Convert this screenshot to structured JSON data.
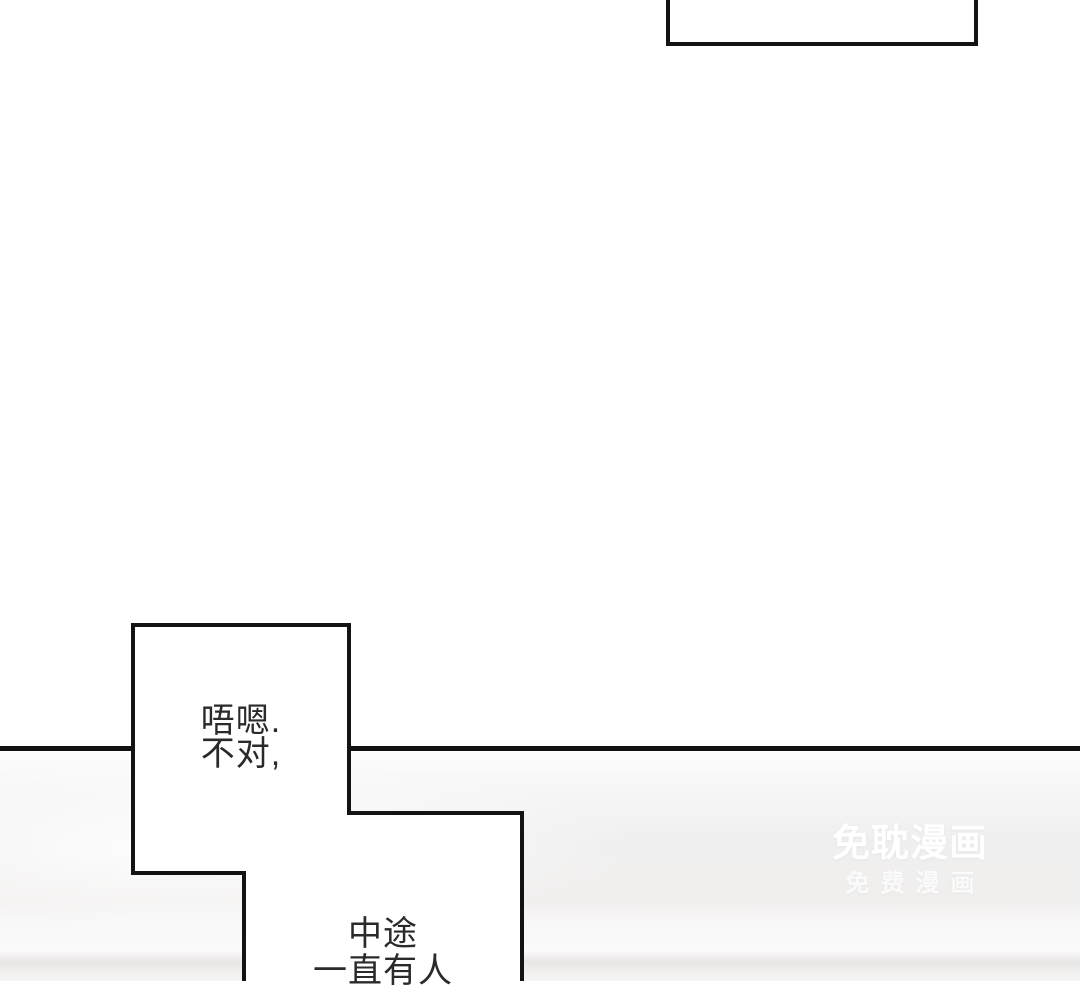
{
  "page": {
    "background_color": "#ffffff",
    "divider_color": "#111111",
    "bubble_border_color": "#131313",
    "bubble_fill_color": "#ffffff",
    "text_color": "#2a2a2a",
    "floor_shadow_color": "#e8e6e5",
    "lower_panel_color": "#f0efef"
  },
  "speech": {
    "bubble_main": {
      "line1": "唔嗯.",
      "line2": "不对,"
    },
    "bubble_bottom": {
      "line1": "中途",
      "line2": "一直有人"
    }
  },
  "watermark": {
    "title": "免耽漫画",
    "subtitle": "免费漫画",
    "color": "#ffffff"
  }
}
